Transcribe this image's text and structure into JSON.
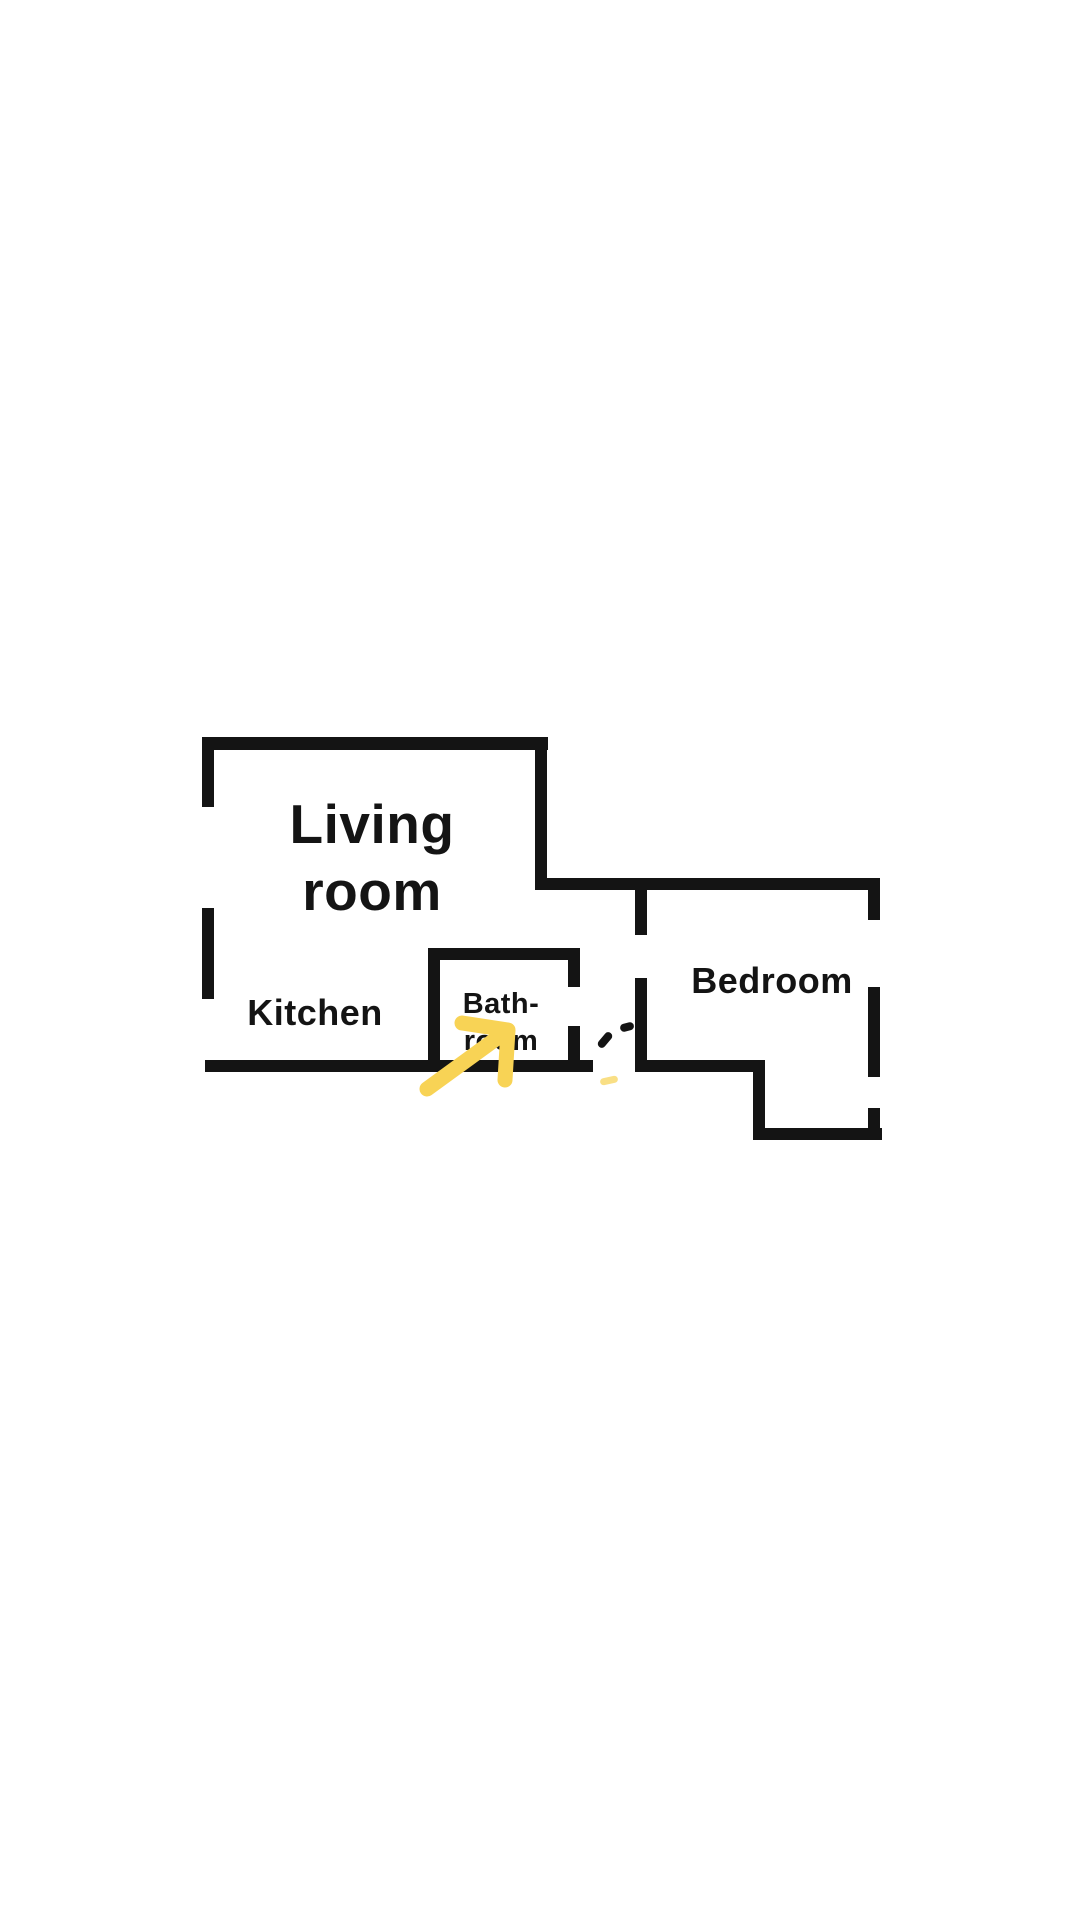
{
  "page": {
    "background_color": "#ffffff"
  },
  "floor_plan": {
    "wall_color": "#141414",
    "text_color": "#141414",
    "arrow_color": "#F8D355",
    "labels": {
      "living_room": {
        "line1": "Living",
        "line2": "room"
      },
      "kitchen": {
        "text": "Kitchen"
      },
      "bathroom": {
        "line1": "Bath-",
        "line2": "room"
      },
      "bedroom": {
        "text": "Bedroom"
      }
    },
    "walls": [
      {
        "name": "living-room-top-wall",
        "x": 202,
        "y": 737,
        "w": 346,
        "h": 13
      },
      {
        "name": "living-room-left-wall-upper",
        "x": 202,
        "y": 737,
        "w": 12,
        "h": 70
      },
      {
        "name": "living-room-left-wall-lower",
        "x": 202,
        "y": 908,
        "w": 12,
        "h": 91
      },
      {
        "name": "living-room-right-wall",
        "x": 535,
        "y": 737,
        "w": 12,
        "h": 153
      },
      {
        "name": "bedroom-top-wall",
        "x": 535,
        "y": 878,
        "w": 345,
        "h": 12
      },
      {
        "name": "kitchen-bottom-wall",
        "x": 205,
        "y": 1060,
        "w": 388,
        "h": 12
      },
      {
        "name": "bathroom-left-wall",
        "x": 428,
        "y": 948,
        "w": 12,
        "h": 124
      },
      {
        "name": "bathroom-top-wall",
        "x": 428,
        "y": 948,
        "w": 152,
        "h": 12
      },
      {
        "name": "bathroom-right-wall-upper",
        "x": 568,
        "y": 948,
        "w": 12,
        "h": 39
      },
      {
        "name": "bathroom-right-wall-lower",
        "x": 568,
        "y": 1026,
        "w": 12,
        "h": 46
      },
      {
        "name": "bedroom-left-wall-upper",
        "x": 635,
        "y": 890,
        "w": 12,
        "h": 45
      },
      {
        "name": "bedroom-left-wall-lower",
        "x": 635,
        "y": 978,
        "w": 12,
        "h": 94
      },
      {
        "name": "bedroom-bottom-wall-upper",
        "x": 635,
        "y": 1060,
        "w": 130,
        "h": 12
      },
      {
        "name": "bedroom-step-wall",
        "x": 753,
        "y": 1060,
        "w": 12,
        "h": 80
      },
      {
        "name": "bedroom-bottom-wall-lower",
        "x": 753,
        "y": 1128,
        "w": 129,
        "h": 12
      },
      {
        "name": "bedroom-right-wall-upper",
        "x": 868,
        "y": 878,
        "w": 12,
        "h": 42
      },
      {
        "name": "bedroom-right-wall-middle",
        "x": 868,
        "y": 987,
        "w": 12,
        "h": 90
      },
      {
        "name": "bedroom-right-wall-lower",
        "x": 868,
        "y": 1108,
        "w": 12,
        "h": 32
      }
    ],
    "door_dashes": [
      {
        "x": 596,
        "y": 1036,
        "w": 18,
        "h": 8,
        "rotate": -50,
        "color": "#141414"
      },
      {
        "x": 620,
        "y": 1023,
        "w": 14,
        "h": 8,
        "rotate": -15,
        "color": "#141414"
      },
      {
        "x": 600,
        "y": 1077,
        "w": 18,
        "h": 7,
        "rotate": -12,
        "color": "#F9DF85"
      }
    ],
    "arrow": {
      "stroke_width": 15,
      "shaft": [
        [
          427,
          1089
        ],
        [
          504,
          1033
        ]
      ],
      "head": [
        [
          462,
          1023
        ],
        [
          508,
          1030
        ],
        [
          505,
          1080
        ]
      ]
    }
  }
}
